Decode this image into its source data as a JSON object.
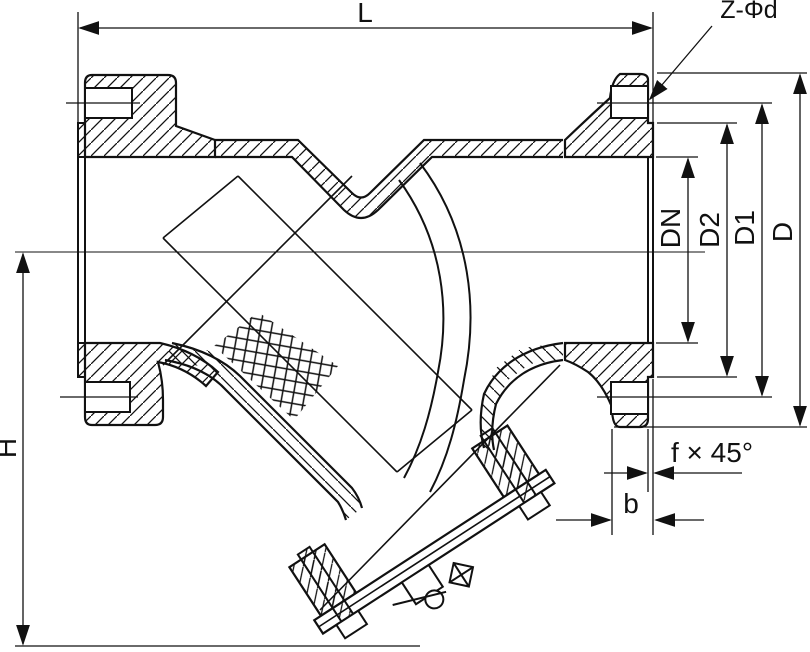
{
  "drawing": {
    "background_color": "#ffffff",
    "line_color": "#111111",
    "labels": {
      "length": "L",
      "bolt_holes": "Z-Φd",
      "nominal_diameter": "DN",
      "raised_face_diameter": "D2",
      "bolt_circle_diameter": "D1",
      "flange_outer_diameter": "D",
      "height": "H",
      "raised_face_chamfer": "f × 45°",
      "flange_thickness": "b"
    }
  }
}
